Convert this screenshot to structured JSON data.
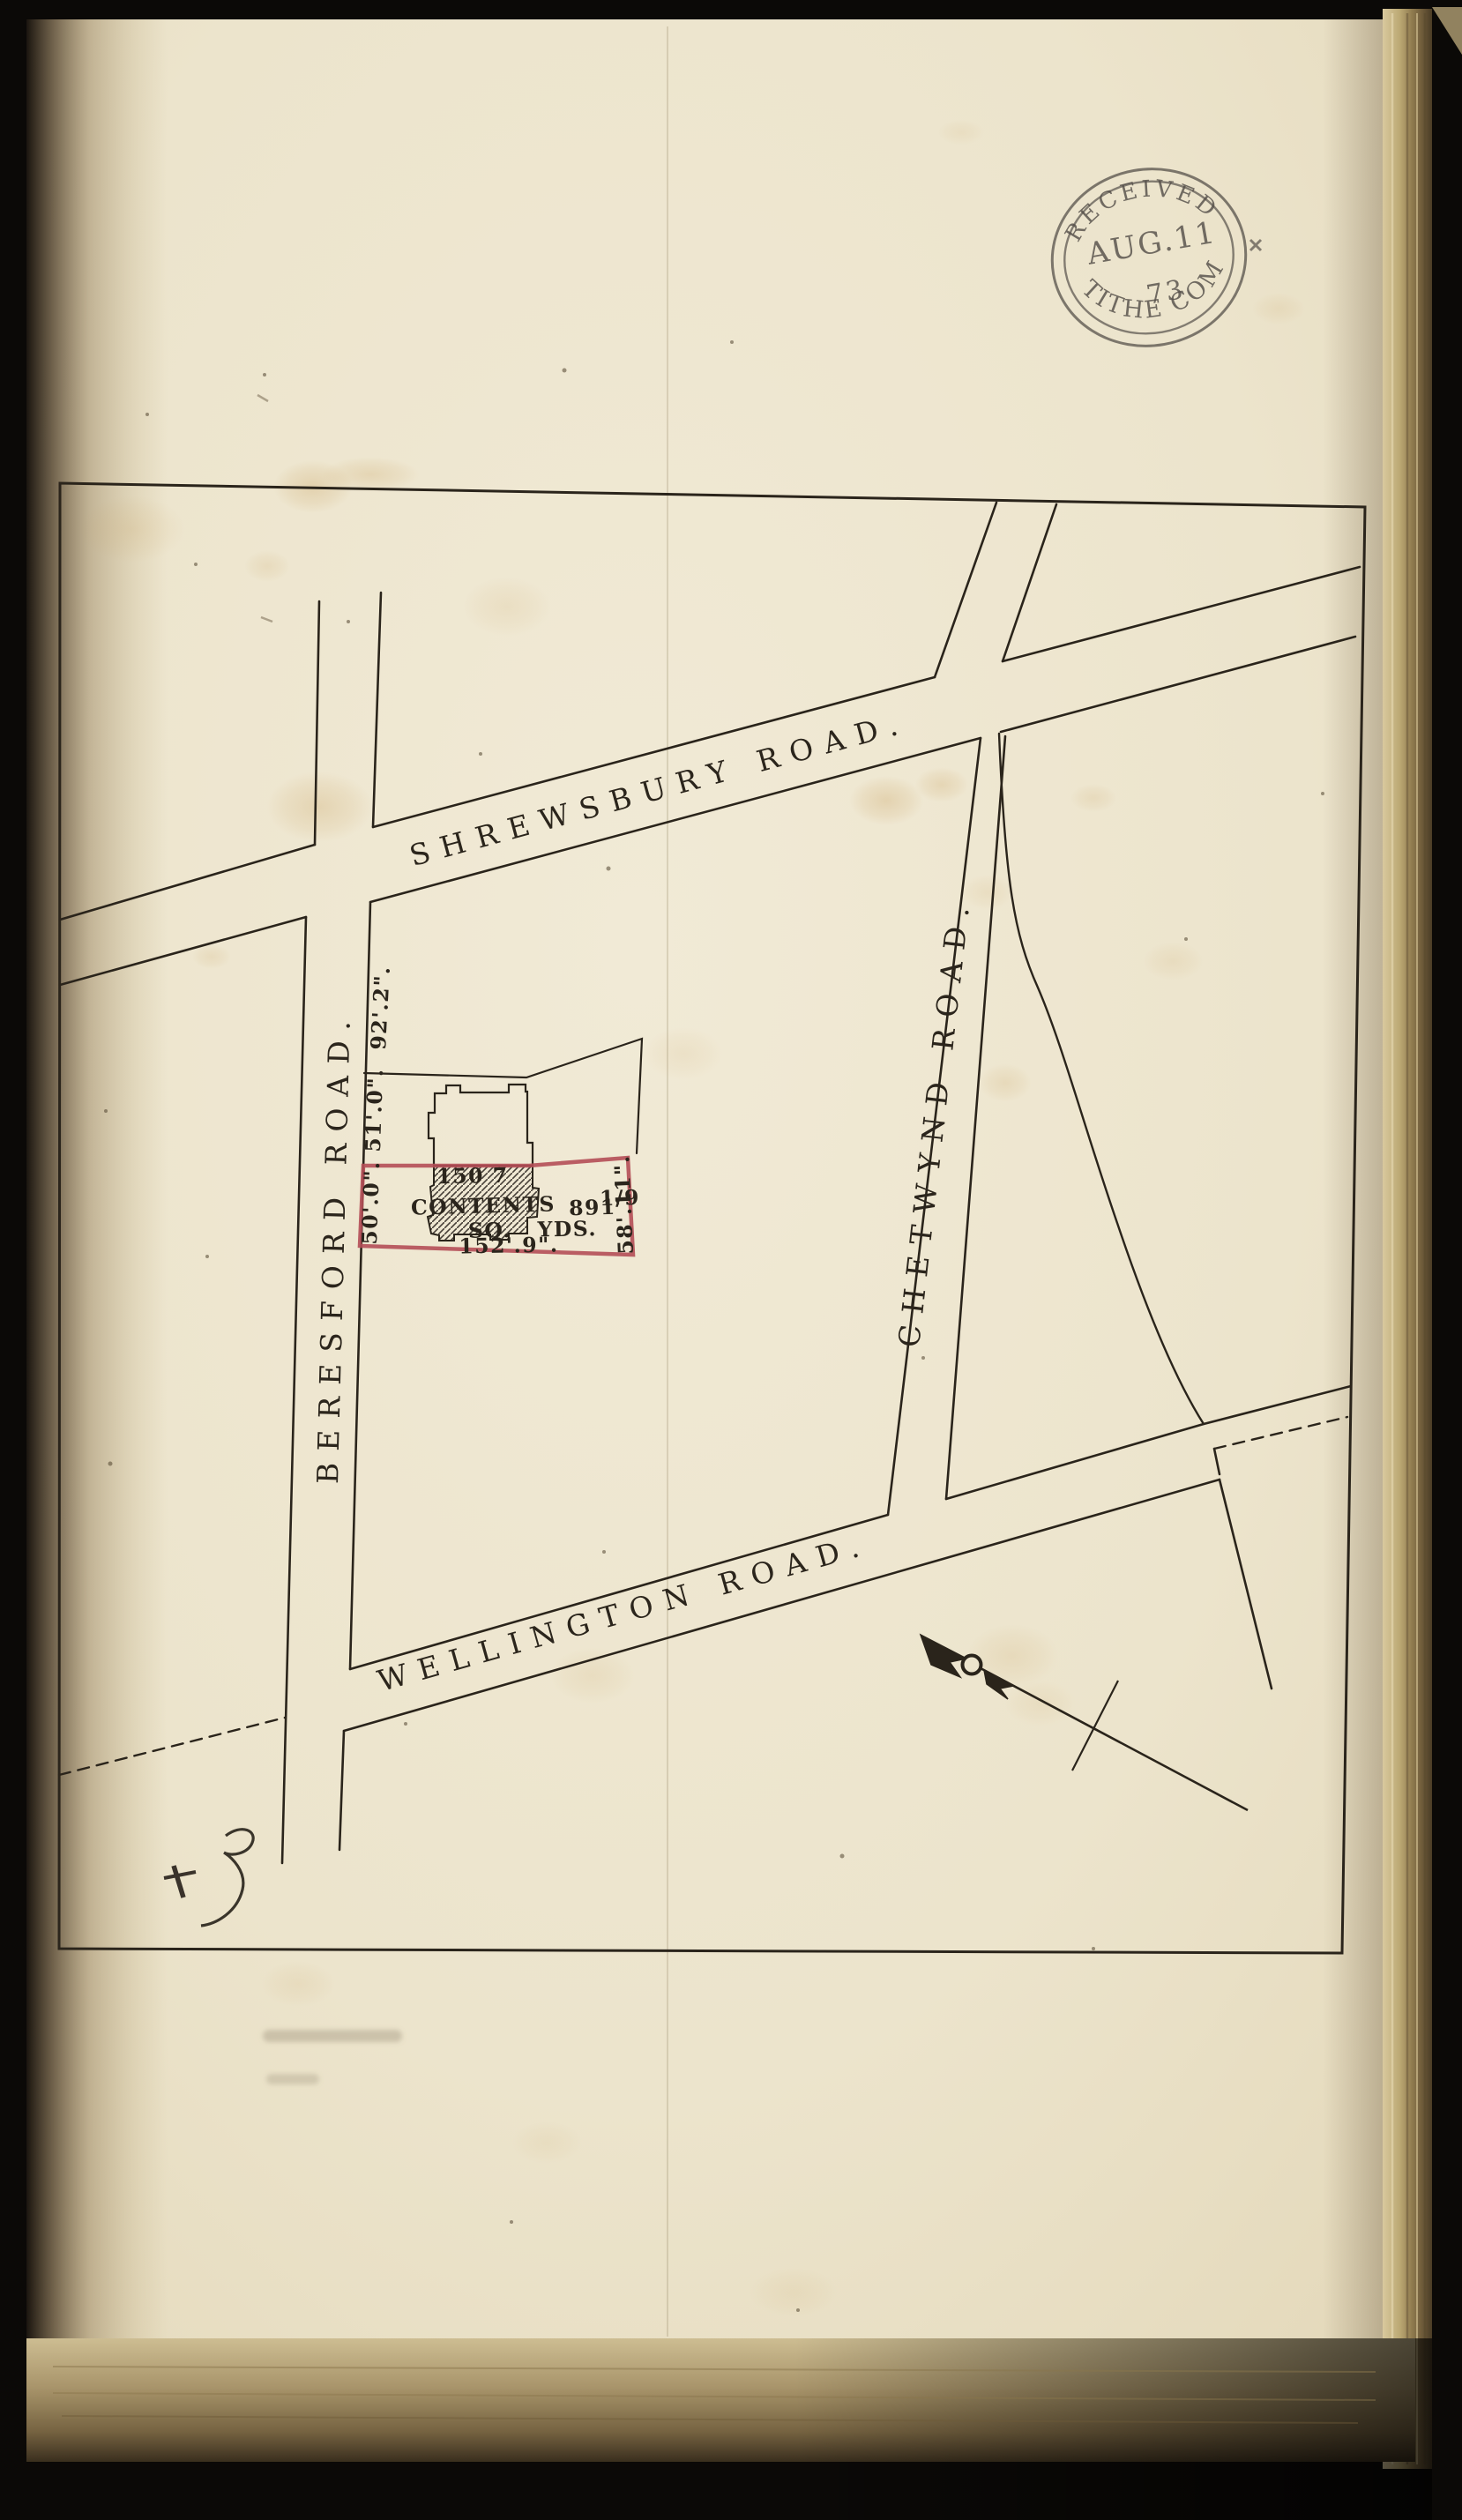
{
  "scene": {
    "description": "Scanned page of a bound volume showing a tithe survey street plan",
    "colors": {
      "backdrop": "#0b0907",
      "paper": "#ece4cc",
      "ink": "#2a241b",
      "plot_red": "#b44e57",
      "stamp_ink": "#56504a"
    }
  },
  "stamp": {
    "top": "RECEIVED",
    "date": "AUG.11",
    "year": "73",
    "bottom": "TITHE COM"
  },
  "map": {
    "road_labels": {
      "shrewsbury": "SHREWSBURY ROAD.",
      "beresford": "BERESFORD ROAD.",
      "chetwynd": "CHETWYND ROAD.",
      "wellington": "WELLINGTON ROAD."
    },
    "measurements": {
      "beresford_frontage": "92'.2\".",
      "upper_parcel_west": "51'.0\".",
      "plot_west": "50'.0\".",
      "plot_east": "58'.11\".",
      "plot_south": "152'.9\".",
      "building": "150 7"
    },
    "plot": {
      "contents_word": "CONTENTS",
      "area": "891",
      "fraction": "1/9",
      "units": "SQ. YDS."
    }
  }
}
